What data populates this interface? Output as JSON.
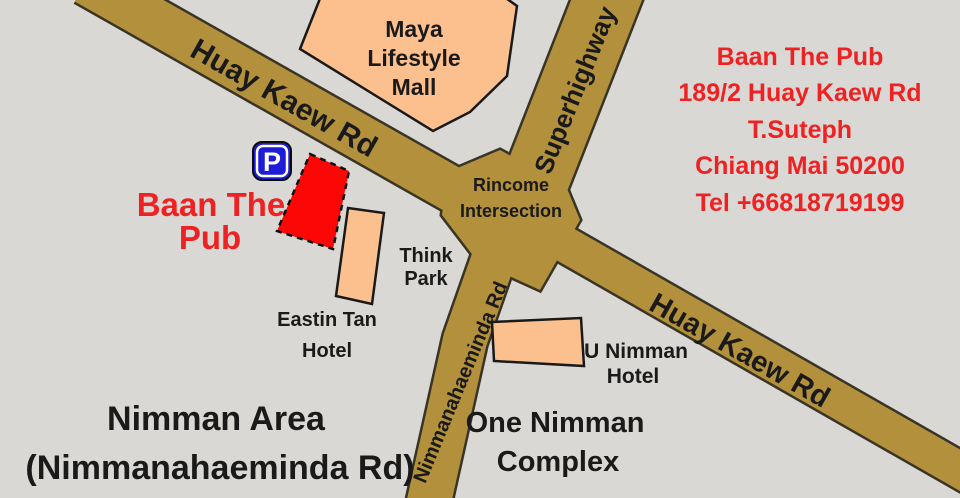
{
  "map": {
    "colors": {
      "background": "#d9d8d4",
      "road": "#b3913c",
      "road_outline": "#3a3426",
      "building": "#fcc08f",
      "venue_building": "#fc0606",
      "red_text": "#ee2222",
      "black_text": "#1a1a1a",
      "parking_blue": "#1c1cd9"
    }
  },
  "roads": {
    "huay_kaew_upper_label": "Huay Kaew Rd",
    "huay_kaew_lower_label": "Huay Kaew Rd",
    "superhighway_label": "Superhighway",
    "nimman_road_label": "Nimmanahaeminda Rd",
    "intersection": {
      "lines": [
        "Rincome",
        "Intersection"
      ]
    }
  },
  "buildings": {
    "maya": {
      "lines": [
        "Maya",
        "Lifestyle",
        "Mall"
      ]
    },
    "think_park": {
      "lines": [
        "Think",
        "Park"
      ]
    },
    "eastin": {
      "lines": [
        "Eastin Tan",
        "Hotel"
      ]
    },
    "u_nimman": {
      "lines": [
        "U Nimman",
        "Hotel"
      ]
    },
    "one_nimman": {
      "lines": [
        "One Nimman",
        "Complex"
      ]
    }
  },
  "areas": {
    "nimman_area": {
      "lines": [
        "Nimman Area",
        "(Nimmanahaeminda Rd)"
      ]
    }
  },
  "venue": {
    "label_lines": [
      "Baan The",
      "Pub"
    ],
    "parking_symbol": "P"
  },
  "address": {
    "lines": [
      "Baan The Pub",
      "189/2 Huay Kaew Rd",
      "T.Suteph",
      "Chiang Mai 50200",
      "Tel +66818719199"
    ]
  }
}
